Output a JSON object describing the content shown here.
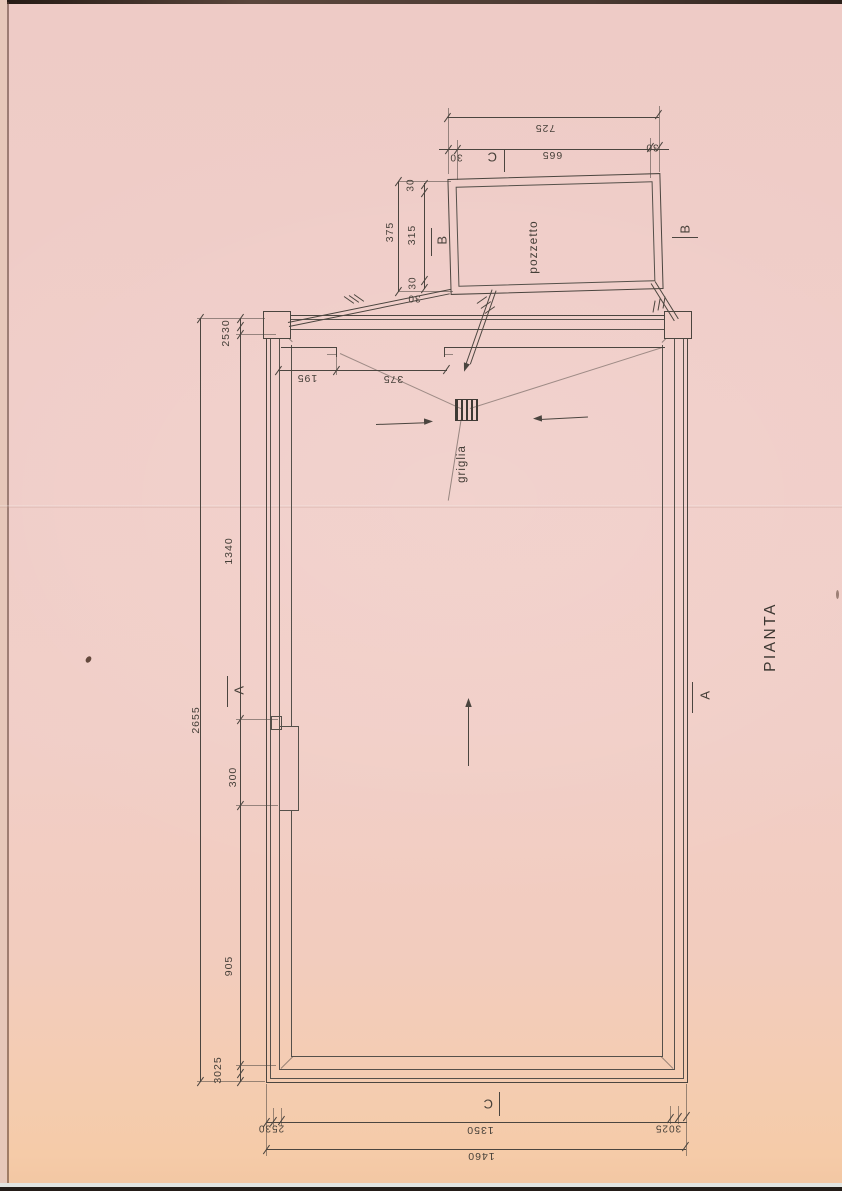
{
  "labels": {
    "title": "PIANTA",
    "pit": "pozzetto",
    "grate": "griglia"
  },
  "sections": {
    "a": "A",
    "b": "B",
    "c": "C"
  },
  "dimensions": {
    "pozzetto": {
      "overall_width": "725",
      "inner_width": "665",
      "wall_left": "30",
      "wall_right": "30",
      "overall_depth": "375",
      "inner_depth": "315",
      "wall_top": "30",
      "wall_bottom": "30",
      "pipe": "30"
    },
    "plan_left": {
      "walls_top": "2530",
      "upper_basin": "1340",
      "recess": "300",
      "lower_basin": "905",
      "walls_bottom": "3025",
      "overall": "2655"
    },
    "plan_interior": {
      "edge_to_channel": "195",
      "channel_to_grate": "375"
    },
    "plan_bottom": {
      "walls_left": "2530",
      "basin_width": "1350",
      "walls_right": "3025",
      "overall": "1460"
    }
  }
}
